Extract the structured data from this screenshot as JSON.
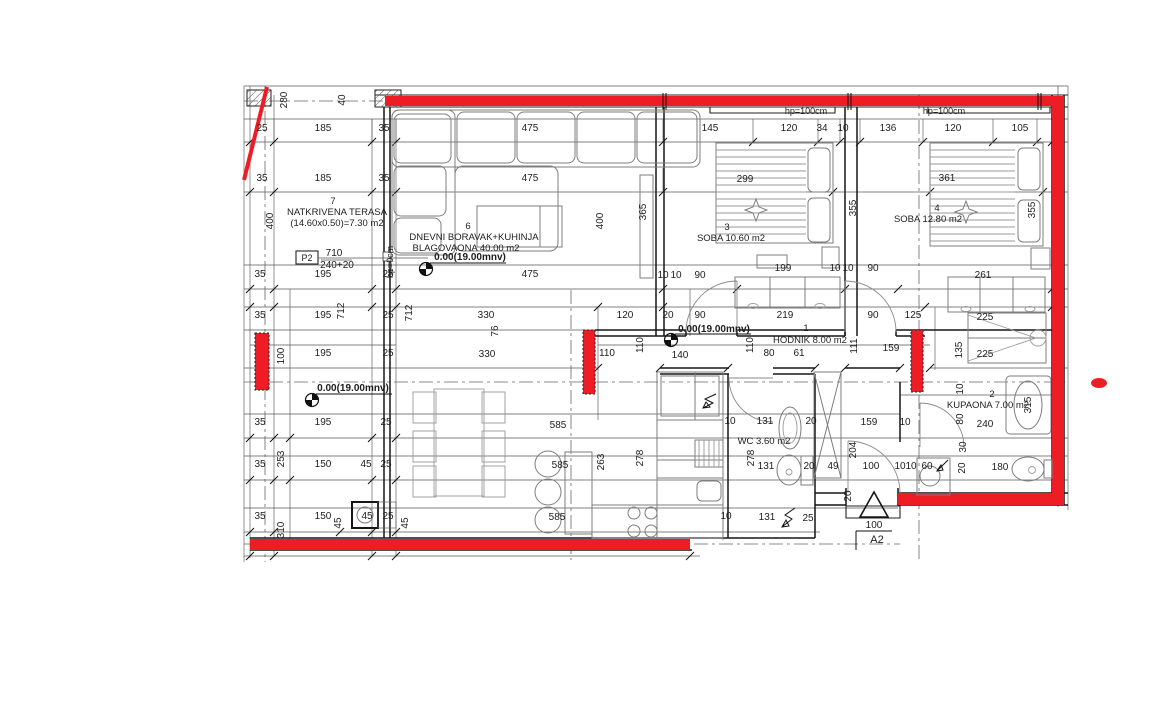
{
  "colors": {
    "wall_red": "#ee1c25",
    "line": "#1c1c1c",
    "furniture": "#7d7d7d",
    "text": "#1d1d1d"
  },
  "rooms": [
    {
      "number": "7",
      "name": "NATKRIVENA TERASA",
      "area": "(14.60x0.50)=7.30 m2"
    },
    {
      "number": "6",
      "name": "DNEVNI BORAVAK+KUHINJA",
      "area": "BLAGOVAONA 40.00 m2"
    },
    {
      "number": "3",
      "name": "SOBA 10.60 m2"
    },
    {
      "number": "4",
      "name": "SOBA 12.80 m2"
    },
    {
      "number": "1",
      "name": "HODNIK 8.00 m2"
    },
    {
      "number": "2",
      "name": "KUPAONA 7.00 m2"
    },
    {
      "number": "",
      "name": "WC 3.60 m2"
    }
  ],
  "room_labels": [
    {
      "t": "7",
      "x": 333,
      "y": 204
    },
    {
      "t": "NATKRIVENA TERASA",
      "x": 337,
      "y": 215
    },
    {
      "t": "(14.60x0.50)=7.30 m2",
      "x": 337,
      "y": 226
    },
    {
      "t": "6",
      "x": 468,
      "y": 229
    },
    {
      "t": "DNEVNI BORAVAK+KUHINJA",
      "x": 474,
      "y": 240
    },
    {
      "t": "BLAGOVAONA 40.00 m2",
      "x": 466,
      "y": 251
    },
    {
      "t": "3",
      "x": 727,
      "y": 230
    },
    {
      "t": "SOBA 10.60 m2",
      "x": 731,
      "y": 241
    },
    {
      "t": "4",
      "x": 937,
      "y": 211
    },
    {
      "t": "SOBA 12.80 m2",
      "x": 928,
      "y": 222
    },
    {
      "t": "1",
      "x": 806,
      "y": 331
    },
    {
      "t": "HODNIK 8.00 m2",
      "x": 810,
      "y": 343
    },
    {
      "t": "2",
      "x": 992,
      "y": 397
    },
    {
      "t": "KUPAONA 7.00 m2",
      "x": 988,
      "y": 408
    },
    {
      "t": "WC 3.60 m2",
      "x": 764,
      "y": 444
    }
  ],
  "annotations": [
    {
      "t": "hp=100cm",
      "x": 806,
      "y": 114,
      "s": 9
    },
    {
      "t": "hp=100cm",
      "x": 944,
      "y": 114,
      "s": 9
    },
    {
      "t": "hp=0cm",
      "x": 393,
      "y": 262,
      "r": -90,
      "s": 9
    },
    {
      "t": "P2",
      "x": 307,
      "y": 261,
      "s": 9
    },
    {
      "t": "710",
      "x": 334,
      "y": 256,
      "s": 10
    },
    {
      "t": "240+20",
      "x": 337,
      "y": 268,
      "s": 10
    },
    {
      "t": "0.00(19.00mnv)",
      "x": 470,
      "y": 260,
      "w": "bold"
    },
    {
      "t": "0.00(19.00mnv)",
      "x": 714,
      "y": 332,
      "w": "bold"
    },
    {
      "t": "0.00(19.00mnv)",
      "x": 353,
      "y": 391,
      "w": "bold"
    },
    {
      "t": "100",
      "x": 874,
      "y": 528,
      "s": 10
    },
    {
      "t": "A2",
      "x": 877,
      "y": 543,
      "s": 11
    }
  ],
  "dim_labels": [
    [
      "25",
      262,
      131
    ],
    [
      "185",
      323,
      131
    ],
    [
      "35",
      384,
      131
    ],
    [
      "475",
      530,
      131
    ],
    [
      "145",
      710,
      131
    ],
    [
      "120",
      789,
      131
    ],
    [
      "34",
      822,
      131
    ],
    [
      "10",
      843,
      131
    ],
    [
      "136",
      888,
      131
    ],
    [
      "120",
      953,
      131
    ],
    [
      "105",
      1020,
      131
    ],
    [
      "35",
      262,
      181
    ],
    [
      "185",
      323,
      181
    ],
    [
      "35",
      384,
      181
    ],
    [
      "475",
      530,
      181
    ],
    [
      "299",
      745,
      182
    ],
    [
      "361",
      947,
      181
    ],
    [
      "280",
      287,
      100,
      -90
    ],
    [
      "40",
      345,
      100,
      -90
    ],
    [
      "400",
      273,
      221,
      -90
    ],
    [
      "400",
      603,
      221,
      -90
    ],
    [
      "365",
      646,
      212,
      -90
    ],
    [
      "355",
      856,
      208,
      -90
    ],
    [
      "355",
      1035,
      210,
      -90
    ],
    [
      "195",
      323,
      277
    ],
    [
      "25",
      388,
      277
    ],
    [
      "475",
      530,
      277
    ],
    [
      "10",
      663,
      278
    ],
    [
      "10",
      676,
      278
    ],
    [
      "90",
      700,
      278
    ],
    [
      "199",
      783,
      271
    ],
    [
      "10",
      835,
      271
    ],
    [
      "10",
      848,
      271
    ],
    [
      "90",
      873,
      271
    ],
    [
      "261",
      983,
      278
    ],
    [
      "35",
      260,
      277
    ],
    [
      "35",
      260,
      318
    ],
    [
      "195",
      323,
      318
    ],
    [
      "25",
      388,
      318
    ],
    [
      "712",
      344,
      311,
      -90
    ],
    [
      "712",
      412,
      313,
      -90
    ],
    [
      "120",
      625,
      318
    ],
    [
      "20",
      668,
      318
    ],
    [
      "90",
      700,
      318
    ],
    [
      "219",
      785,
      318
    ],
    [
      "90",
      873,
      318
    ],
    [
      "125",
      913,
      318
    ],
    [
      "225",
      985,
      320
    ],
    [
      "330",
      486,
      318
    ],
    [
      "76",
      498,
      331,
      -90
    ],
    [
      "330",
      487,
      357
    ],
    [
      "100",
      284,
      356,
      -90
    ],
    [
      "195",
      323,
      356
    ],
    [
      "25",
      388,
      356
    ],
    [
      "110",
      607,
      356
    ],
    [
      "110",
      643,
      345,
      -90
    ],
    [
      "140",
      680,
      358
    ],
    [
      "80",
      769,
      356
    ],
    [
      "61",
      799,
      356
    ],
    [
      "110",
      753,
      345,
      -90
    ],
    [
      "111",
      857,
      346,
      -90
    ],
    [
      "159",
      891,
      351
    ],
    [
      "135",
      962,
      350,
      -90
    ],
    [
      "225",
      985,
      357
    ],
    [
      "35",
      260,
      425
    ],
    [
      "195",
      323,
      425
    ],
    [
      "25",
      386,
      425
    ],
    [
      "585",
      558,
      428
    ],
    [
      "253",
      284,
      459,
      -90
    ],
    [
      "35",
      260,
      467
    ],
    [
      "150",
      323,
      467
    ],
    [
      "45",
      366,
      467
    ],
    [
      "25",
      386,
      467
    ],
    [
      "585",
      560,
      468
    ],
    [
      "35",
      260,
      519
    ],
    [
      "150",
      323,
      519
    ],
    [
      "45",
      367,
      519
    ],
    [
      "25",
      388,
      519
    ],
    [
      "310",
      284,
      530,
      -90
    ],
    [
      "45",
      341,
      523,
      -90
    ],
    [
      "45",
      408,
      523,
      -90
    ],
    [
      "585",
      557,
      520
    ],
    [
      "263",
      604,
      462,
      -90
    ],
    [
      "278",
      643,
      458,
      -90
    ],
    [
      "278",
      754,
      458,
      -90
    ],
    [
      "10",
      730,
      424
    ],
    [
      "131",
      765,
      424
    ],
    [
      "20",
      811,
      424
    ],
    [
      "159",
      869,
      425
    ],
    [
      "10",
      905,
      425
    ],
    [
      "131",
      766,
      469
    ],
    [
      "20",
      809,
      469
    ],
    [
      "49",
      833,
      469
    ],
    [
      "100",
      871,
      469
    ],
    [
      "10",
      726,
      519
    ],
    [
      "131",
      767,
      520
    ],
    [
      "25",
      808,
      521
    ],
    [
      "204",
      856,
      450,
      -90
    ],
    [
      "20",
      851,
      496,
      -90
    ],
    [
      "10",
      963,
      389,
      -90
    ],
    [
      "80",
      963,
      419,
      -90
    ],
    [
      "240",
      985,
      427
    ],
    [
      "30",
      966,
      447,
      -90
    ],
    [
      "20",
      965,
      468,
      -90
    ],
    [
      "180",
      1000,
      470
    ],
    [
      "315",
      1031,
      405,
      -90
    ],
    [
      "10",
      900,
      469
    ],
    [
      "10",
      911,
      469
    ],
    [
      "60",
      927,
      469
    ]
  ],
  "level_markers": [
    {
      "x": 426,
      "y": 269
    },
    {
      "x": 671,
      "y": 340
    },
    {
      "x": 312,
      "y": 400
    }
  ],
  "section_marker": {
    "dim": "100",
    "name": "A2"
  },
  "p2_detail": {
    "code": "P2",
    "top": "710",
    "bottom": "240+20"
  }
}
